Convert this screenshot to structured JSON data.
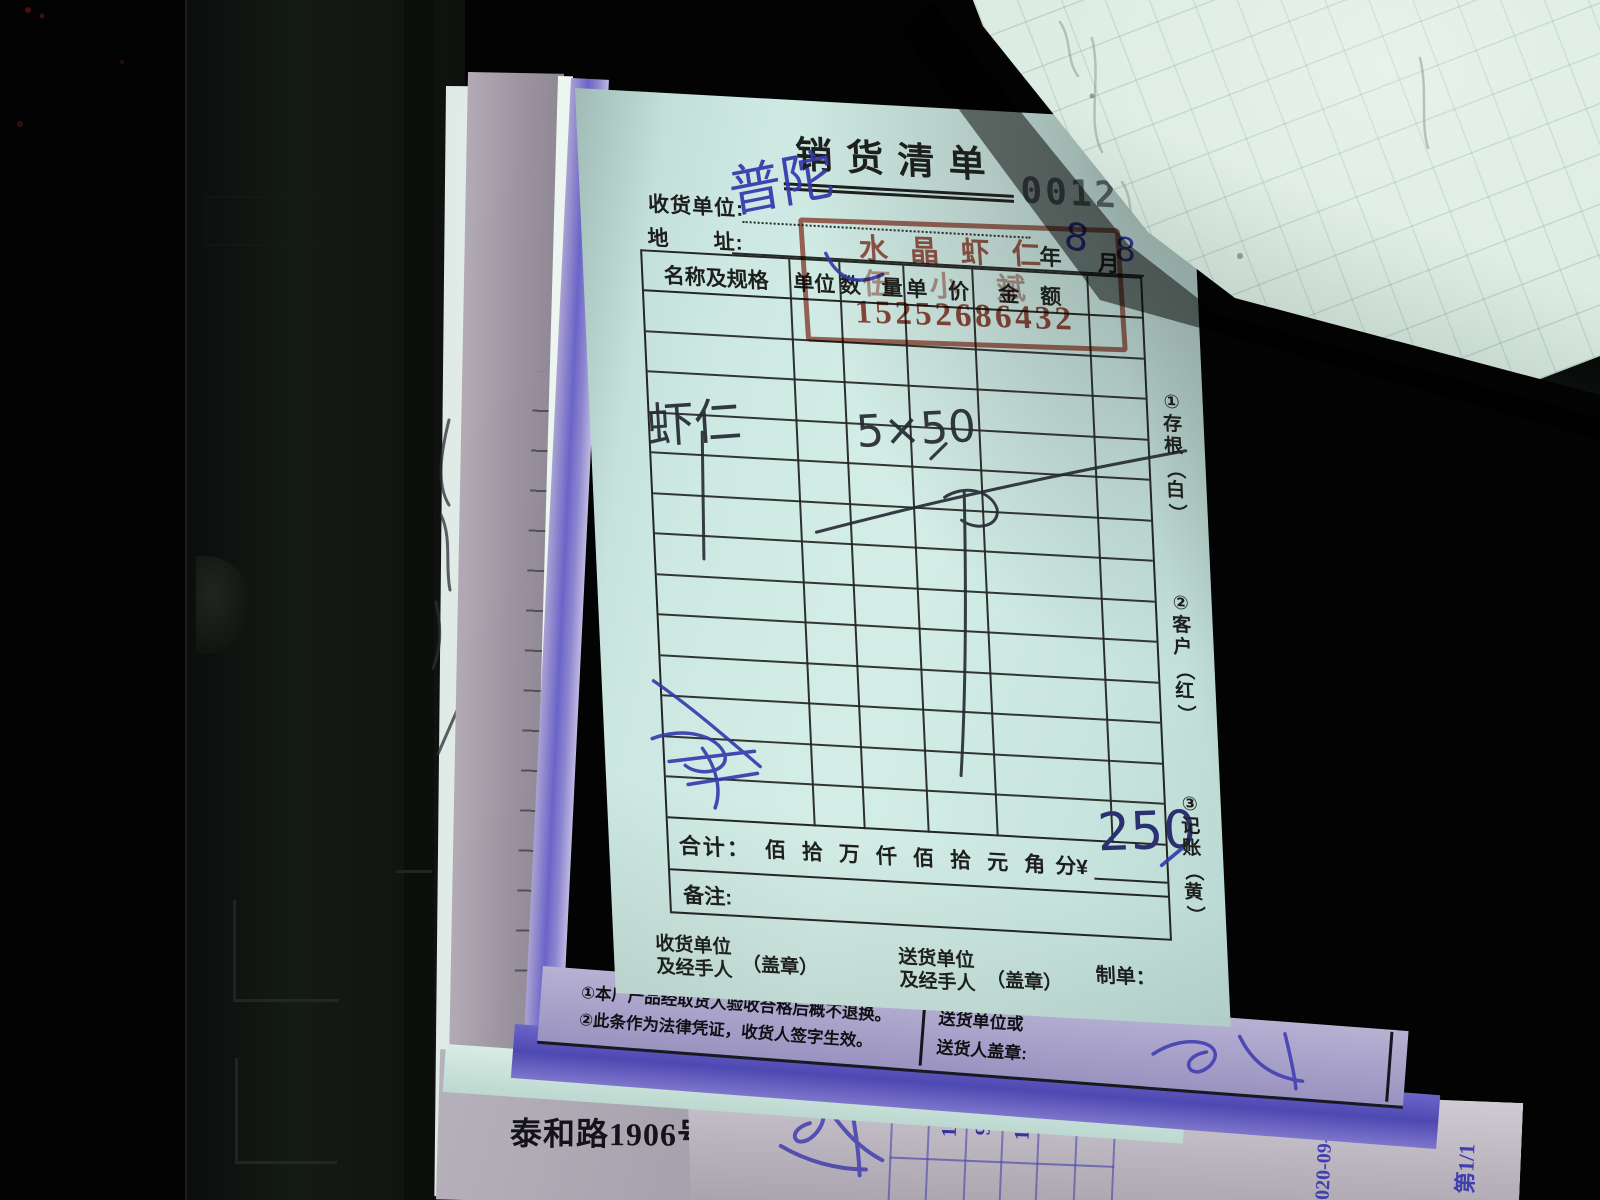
{
  "receipt": {
    "title": "销货清单",
    "serial": "0012",
    "consignee_label": "收货单位:",
    "address_label": "地　　址:",
    "date_year": "年",
    "date_month": "月",
    "handwriting": {
      "consignee": "普陀",
      "month": "8",
      "day": "8",
      "item": "虾仁",
      "qty_price": "5×50",
      "total": "250"
    },
    "table": {
      "headers": [
        "名称及规格",
        "单位",
        "数　量",
        "单　价",
        "金　额"
      ],
      "body_rows": 13
    },
    "total_label": "合计：",
    "total_units": [
      "佰",
      "拾",
      "万",
      "仟",
      "佰",
      "拾",
      "元",
      "角"
    ],
    "total_suffix": "分¥",
    "remark_label": "备注:",
    "footer": {
      "left_line1": "收货单位",
      "left_line2": "及经手人",
      "left_seal": "（盖章）",
      "mid_line1": "送货单位",
      "mid_line2": "及经手人",
      "mid_seal": "（盖章）",
      "maker_label": "制单："
    },
    "copies": [
      "①存根（白）",
      "②客户（红）",
      "③记账（黄）"
    ],
    "stamp": {
      "line1": "水晶虾仁",
      "line2": "伍小斌",
      "phone": "15252686432"
    }
  },
  "notes_strip": {
    "note1": "①本厂产品经取货人验收合格后概不退换。",
    "note2": "②此条作为法律凭证，收货人签字生效。",
    "right_line1": "送货单位或",
    "right_line2": "送货人盖章:"
  },
  "bottom_sheet": {
    "address": "泰和路1906号A03-04"
  },
  "side_receipt": {
    "col_header": "额",
    "values": [
      "100",
      "90",
      "100"
    ],
    "serial_date": "020-09-08",
    "page": "第1/1"
  },
  "colors": {
    "paper_cyan": "#cde8e2",
    "stamp_red": "#993322",
    "ink_blue": "#3338ac",
    "ink_black": "#242932",
    "carbon_blue": "#6b64c8"
  }
}
